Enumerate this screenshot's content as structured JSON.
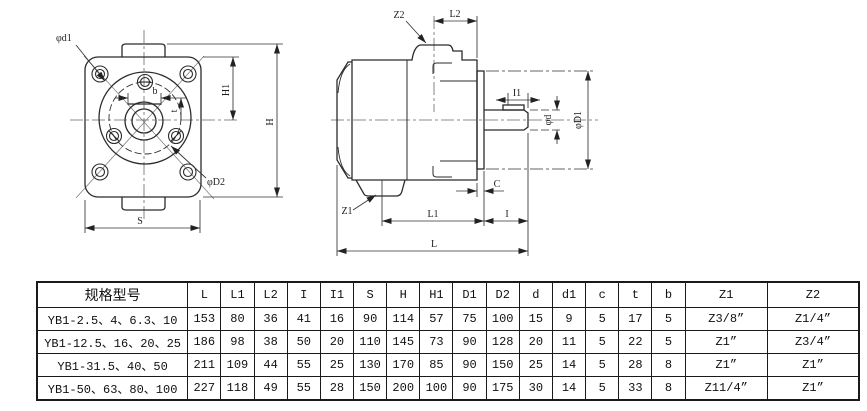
{
  "drawing": {
    "front_view": {
      "labels": {
        "phi_d1": "φd1",
        "b": "b",
        "t": "t",
        "H1": "H1",
        "H": "H",
        "phi_D2": "φD2",
        "S": "S"
      }
    },
    "side_view": {
      "labels": {
        "Z2": "Z2",
        "L2": "L2",
        "I1": "I1",
        "phi_d": "φd",
        "phi_D1": "φD1",
        "C": "C",
        "Z1": "Z1",
        "L1": "L1",
        "I": "I",
        "L": "L"
      }
    }
  },
  "table": {
    "headers": [
      "规格型号",
      "L",
      "L1",
      "L2",
      "I",
      "I1",
      "S",
      "H",
      "H1",
      "D1",
      "D2",
      "d",
      "d1",
      "c",
      "t",
      "b",
      "Z1",
      "Z2"
    ],
    "rows": [
      [
        "YB1-2.5、4、6.3、10",
        "153",
        "80",
        "36",
        "41",
        "16",
        "90",
        "114",
        "57",
        "75",
        "100",
        "15",
        "9",
        "5",
        "17",
        "5",
        "Z3/8”",
        "Z1/4”"
      ],
      [
        "YB1-12.5、16、20、25",
        "186",
        "98",
        "38",
        "50",
        "20",
        "110",
        "145",
        "73",
        "90",
        "128",
        "20",
        "11",
        "5",
        "22",
        "5",
        "Z1”",
        "Z3/4”"
      ],
      [
        "YB1-31.5、40、50",
        "211",
        "109",
        "44",
        "55",
        "25",
        "130",
        "170",
        "85",
        "90",
        "150",
        "25",
        "14",
        "5",
        "28",
        "8",
        "Z1”",
        "Z1”"
      ],
      [
        "YB1-50、63、80、100",
        "227",
        "118",
        "49",
        "55",
        "28",
        "150",
        "200",
        "100",
        "90",
        "175",
        "30",
        "14",
        "5",
        "33",
        "8",
        "Z11/4”",
        "Z1”"
      ]
    ]
  }
}
